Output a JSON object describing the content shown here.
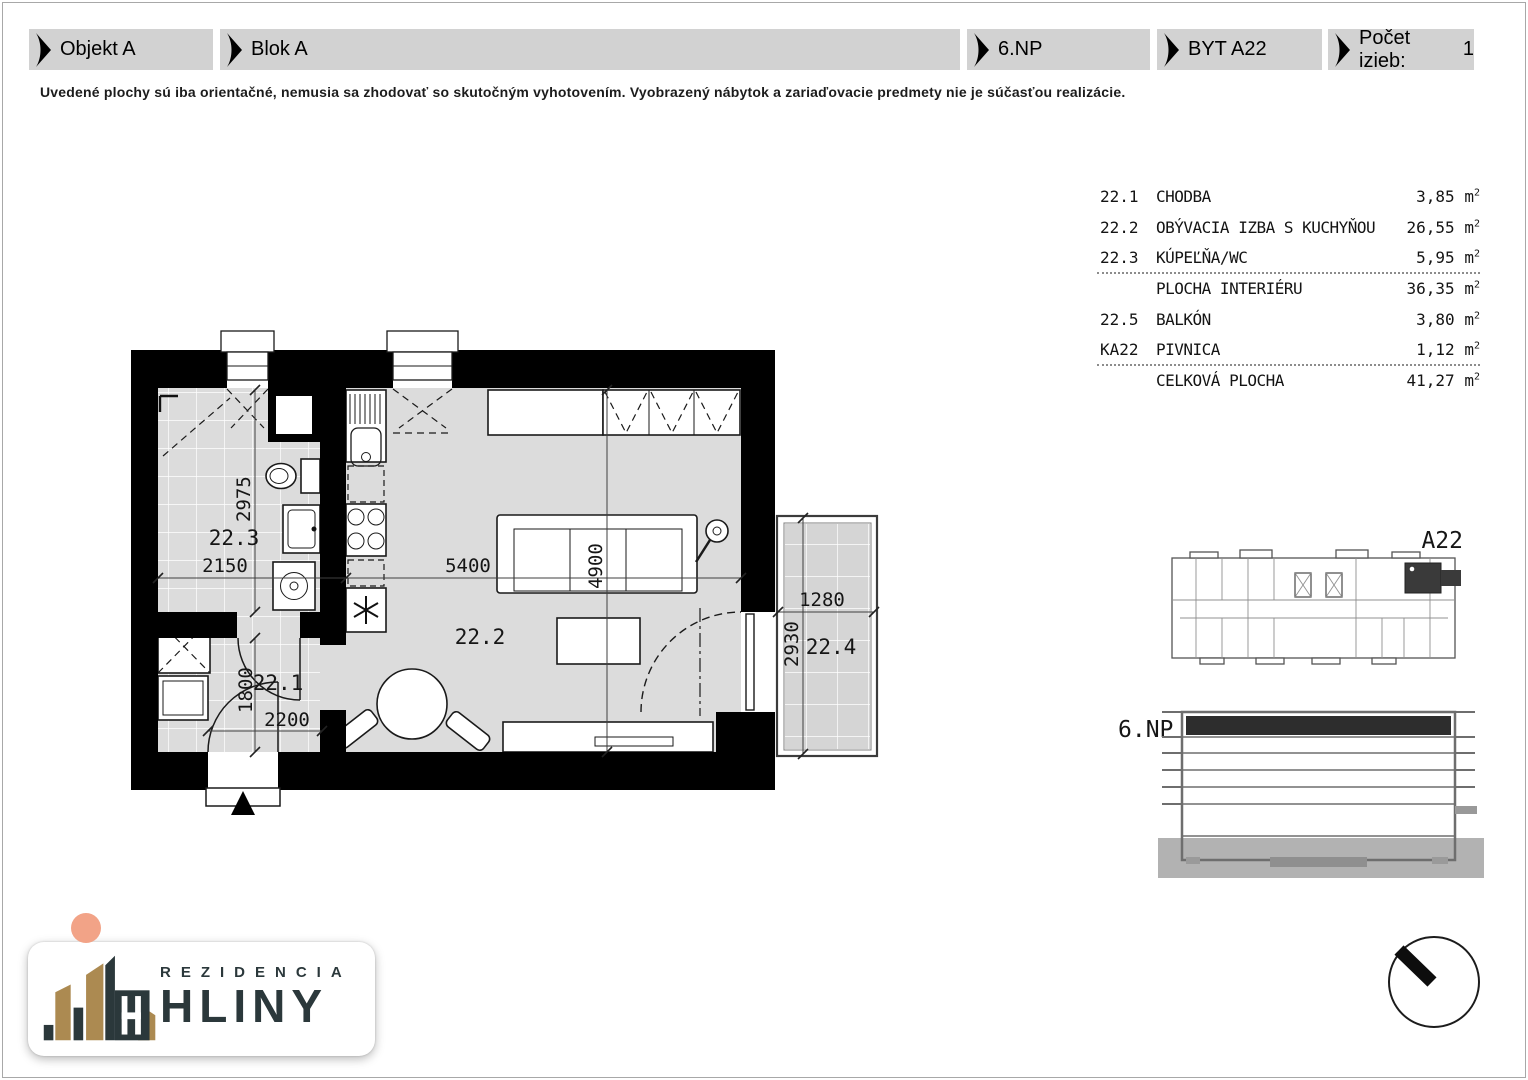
{
  "header": {
    "objekt": "Objekt A",
    "blok": "Blok A",
    "floor": "6.NP",
    "unit": "BYT A22",
    "rooms_label": "Počet izieb:",
    "rooms_value": "1"
  },
  "disclaimer": "Uvedené plochy sú iba orientačné, nemusia sa zhodovať so skutočným vyhotovením. Vyobrazený nábytok a zariaďovacie predmety nie je súčasťou realizácie.",
  "area_table": {
    "unit_base": "m",
    "unit_exp": "2",
    "rows": [
      {
        "code": "22.1",
        "name": "CHODBA",
        "value": "3,85"
      },
      {
        "code": "22.2",
        "name": "OBÝVACIA IZBA S KUCHYŇOU",
        "value": "26,55"
      },
      {
        "code": "22.3",
        "name": "KÚPEĽŇA/WC",
        "value": "5,95"
      },
      {
        "code": "",
        "name": "PLOCHA INTERIÉRU",
        "value": "36,35"
      },
      {
        "code": "22.5",
        "name": "BALKÓN",
        "value": "3,80"
      },
      {
        "code": "KA22",
        "name": "PIVNICA",
        "value": "1,12"
      },
      {
        "code": "",
        "name": "CELKOVÁ PLOCHA",
        "value": "41,27"
      }
    ]
  },
  "plan": {
    "rooms": {
      "hall": "22.1",
      "living": "22.2",
      "bath": "22.3",
      "balcony": "22.4"
    },
    "dims": {
      "bath_w": "2150",
      "bath_h": "2975",
      "living_w": "5400",
      "living_h": "4900",
      "hall_h": "1800",
      "hall_w": "2200",
      "balcony_w": "1280",
      "balcony_h": "2930"
    }
  },
  "key_plan": {
    "label": "A22"
  },
  "elevation": {
    "label": "6.NP"
  },
  "logo": {
    "brand_top": "REZIDENCIA",
    "brand_bottom": "HLINY"
  },
  "colors": {
    "header_bg": "#d2d2d2",
    "plan_floor": "#dcdcdc",
    "wall": "#000000",
    "highlight_unit": "#3a3a3a",
    "accent_gold": "#ac8a51",
    "accent_dark": "#2b383b",
    "accent_salmon": "#f2a387"
  }
}
